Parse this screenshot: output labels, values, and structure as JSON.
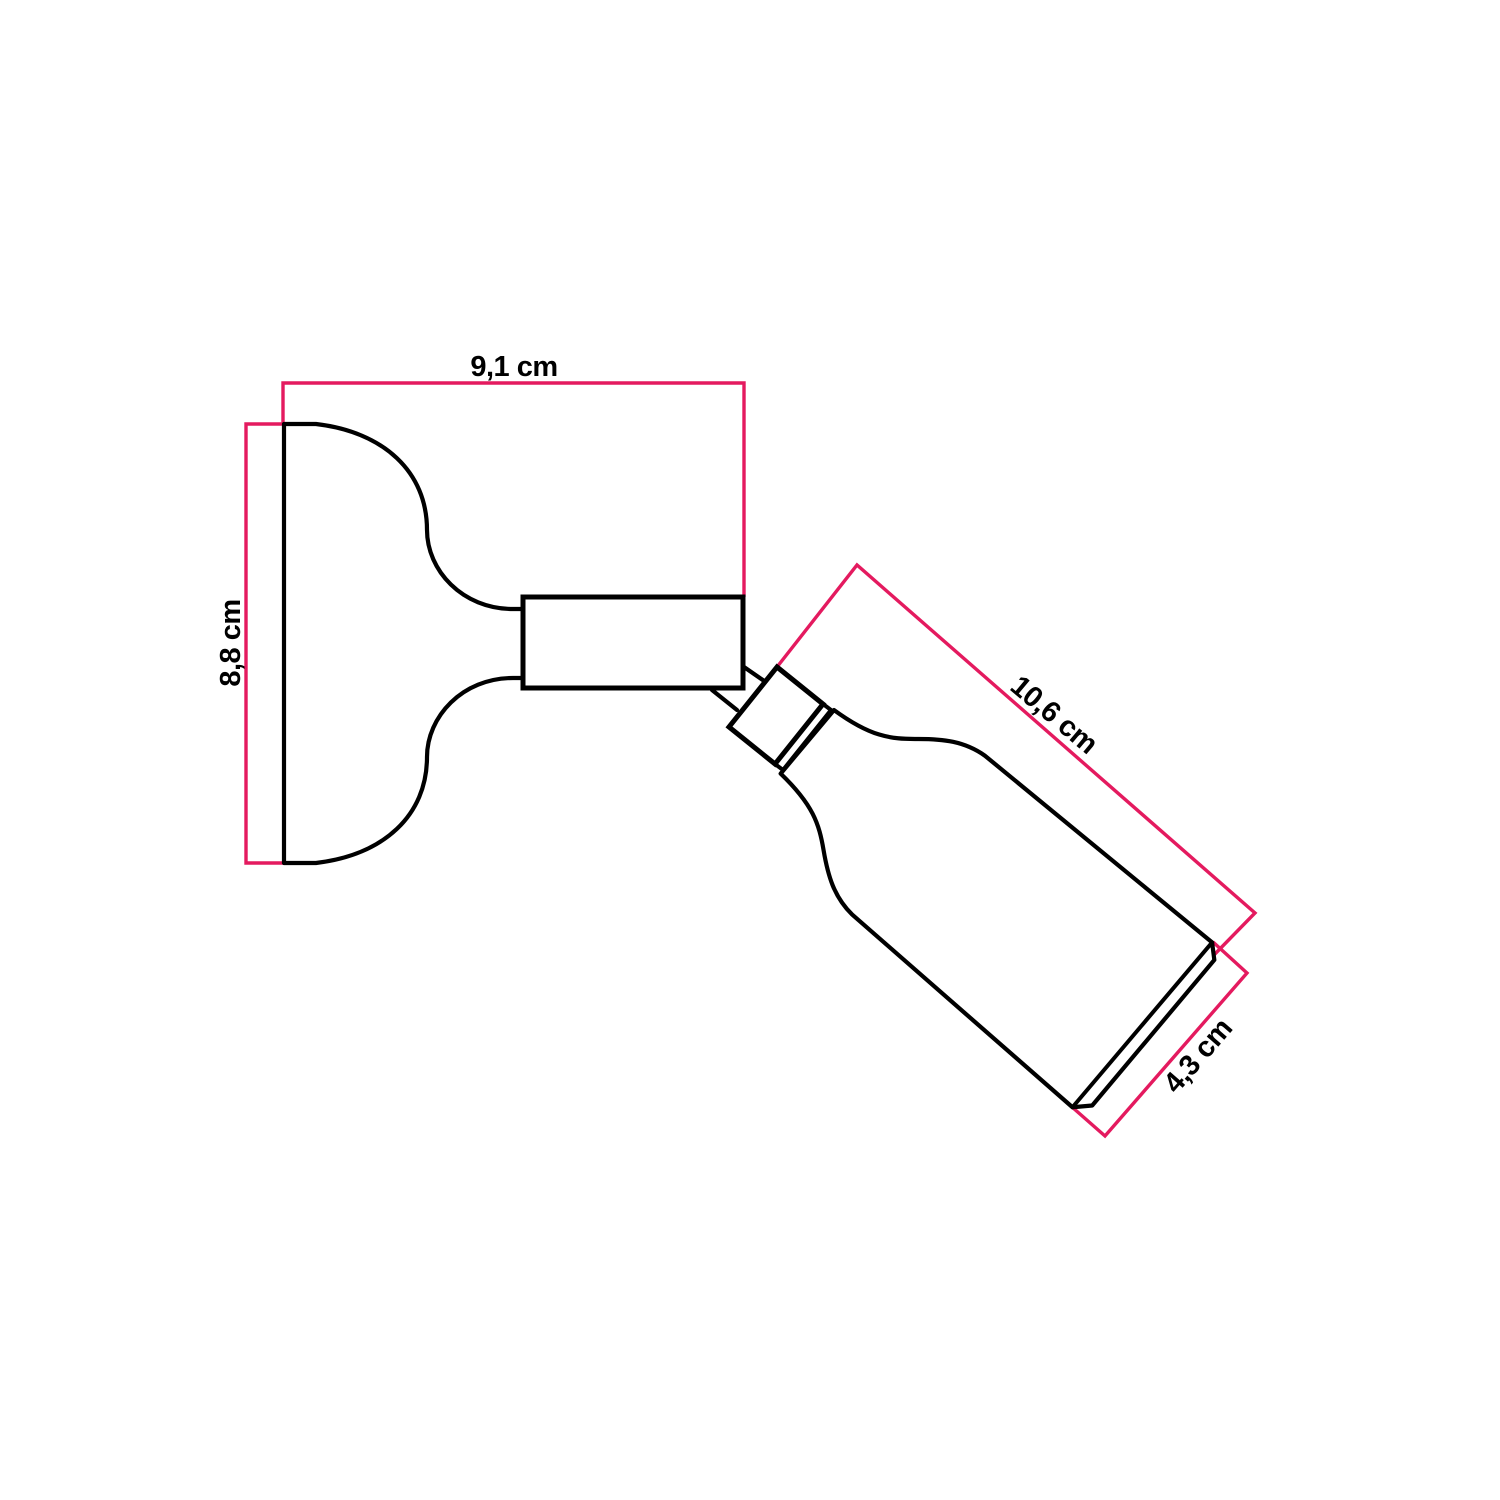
{
  "page": {
    "background": "#ffffff"
  },
  "drawing": {
    "type": "technical-dimension-diagram",
    "subject": "adjustable wall lamp with swivel joint",
    "stroke_color": "#000000",
    "dimension_color": "#e41a5f",
    "unit": "cm",
    "labels": {
      "base_width": "9,1 cm",
      "base_height": "8,8 cm",
      "lamp_length": "10,6 cm",
      "lamp_diameter": "4,3 cm"
    }
  }
}
